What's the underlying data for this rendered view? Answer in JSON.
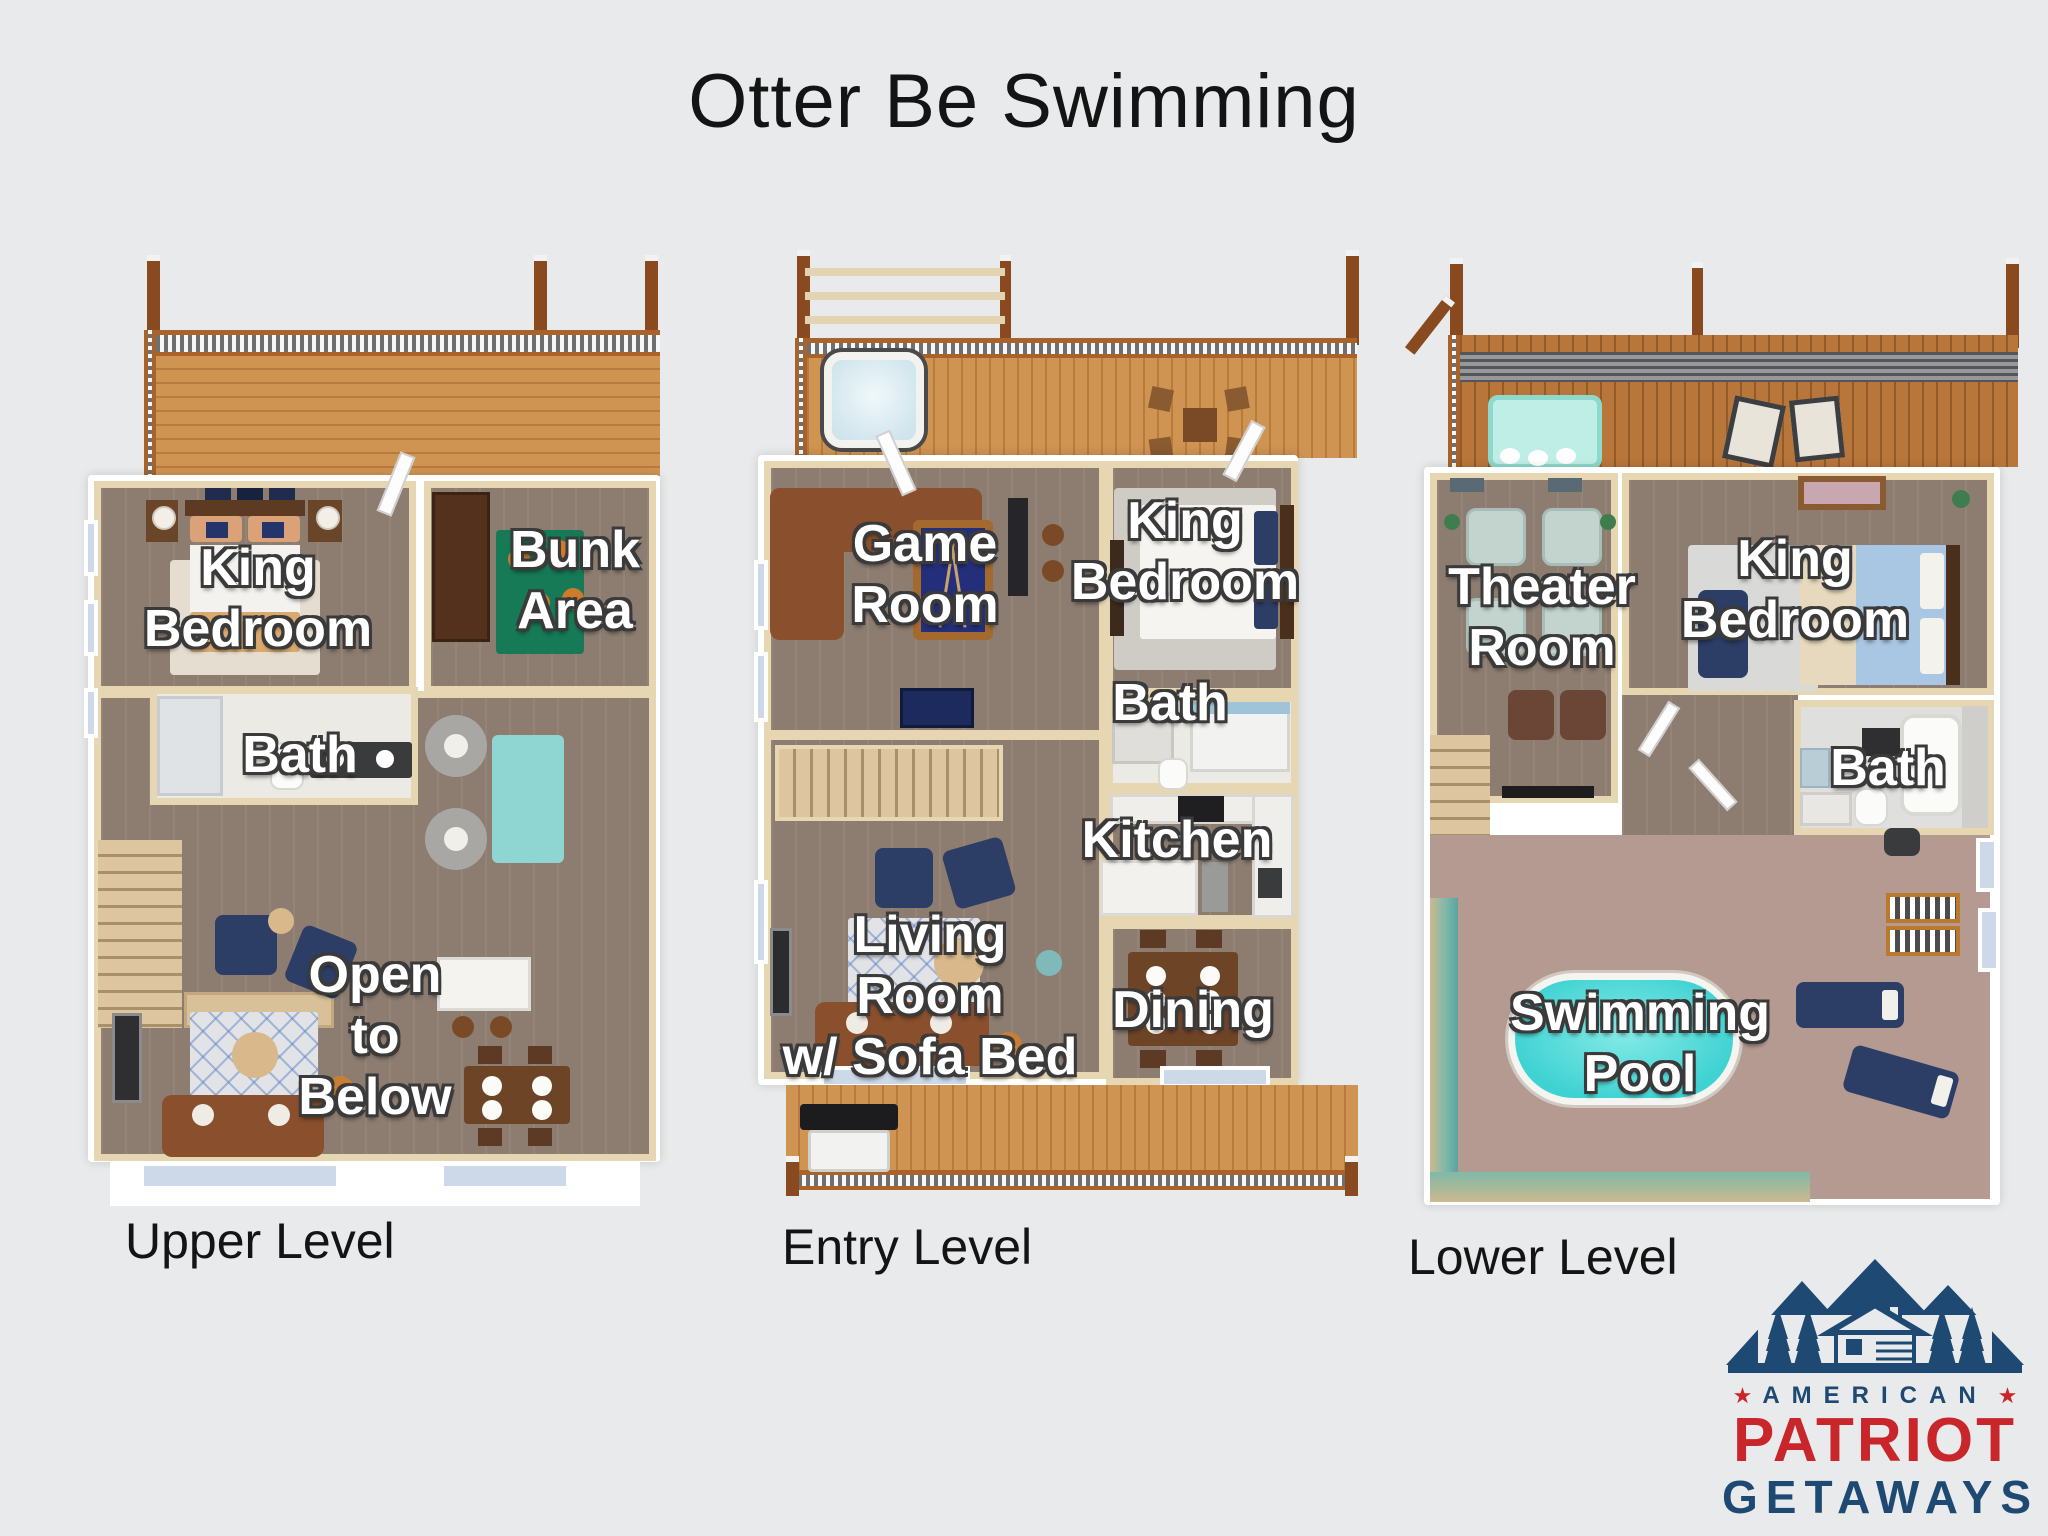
{
  "title": "Otter Be Swimming",
  "levels": [
    {
      "caption": "Upper Level",
      "rooms": [
        {
          "label": "King\nBedroom"
        },
        {
          "label": "Bunk\nArea"
        },
        {
          "label": "Bath"
        },
        {
          "label": "Open\nto\nBelow"
        }
      ]
    },
    {
      "caption": "Entry Level",
      "rooms": [
        {
          "label": "Game\nRoom"
        },
        {
          "label": "King\nBedroom"
        },
        {
          "label": "Bath"
        },
        {
          "label": "Kitchen"
        },
        {
          "label": "Living\nRoom\nw/ Sofa Bed"
        },
        {
          "label": "Dining"
        }
      ]
    },
    {
      "caption": "Lower Level",
      "rooms": [
        {
          "label": "Theater\nRoom"
        },
        {
          "label": "King\nBedroom"
        },
        {
          "label": "Bath"
        },
        {
          "label": "Swimming\nPool"
        }
      ]
    }
  ],
  "logo": {
    "star": "★",
    "top": "AMERICAN",
    "name": "PATRIOT",
    "bottom": "GETAWAYS"
  },
  "colors": {
    "background": "#e9eaeb",
    "title_text": "#141414",
    "caption_text": "#141414",
    "room_label_text": "#ffffff",
    "room_label_outline": "#3a3a3a",
    "deck_wood": "#cf9352",
    "lower_deck_wood": "#b9763a",
    "interior_floor": "#8d7d70",
    "wall": "#ffffff",
    "wall_lining": "#e6d6b2",
    "pool_water": "#3ed2d2",
    "hot_tub": "#cfe4ec",
    "pool_table_felt": "#232f7a",
    "pool_room_tile": "#b49a90",
    "logo_navy": "#1d4973",
    "logo_red": "#c9262c"
  }
}
